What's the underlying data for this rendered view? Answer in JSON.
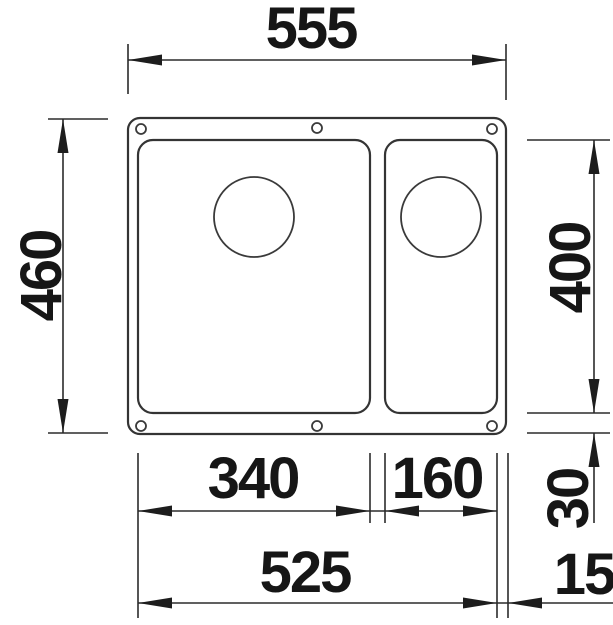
{
  "drawing": {
    "title": "sink-undermount-dimension-drawing",
    "subject": "top view of a one-and-a-half bowl undermount sink with drain holes and six mounting holes",
    "view": "plan",
    "background_color": "#ffffff",
    "line_color": "#343434",
    "dimension_line_color": "#2b2b2b",
    "text_color": "#161616"
  },
  "dimensions": {
    "overall_width": {
      "label": "555",
      "role": "overall width, top horizontal dimension"
    },
    "overall_depth": {
      "label": "460",
      "role": "overall depth, left vertical dimension (rotated text)"
    },
    "bowl_depth": {
      "label": "400",
      "role": "bowl inner depth, right vertical dimension (rotated text)"
    },
    "main_bowl_width": {
      "label": "340",
      "role": "main bowl inner width, bottom horizontal dimension"
    },
    "small_bowl_width": {
      "label": "160",
      "role": "small bowl inner width, bottom horizontal dimension"
    },
    "bottom_margin": {
      "label": "30",
      "role": "margin between bowl bottom and sink edge, right vertical dimension (rotated text)"
    },
    "inner_span": {
      "label": "525",
      "role": "span across both bowl cut-outs, bottom horizontal dimension"
    },
    "right_margin": {
      "label": "15",
      "role": "margin between small bowl and sink outer edge, bottom right dimension"
    }
  }
}
